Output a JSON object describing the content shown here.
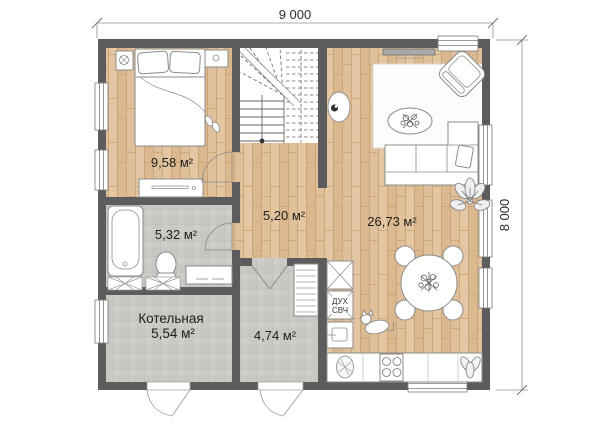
{
  "dimensions": {
    "width": "9 000",
    "height": "8 000"
  },
  "rooms": {
    "bedroom": {
      "area": "9,58 м²"
    },
    "bathroom": {
      "area": "5,32 м²"
    },
    "boiler_room": {
      "name": "Котельная",
      "area": "5,54 м²"
    },
    "hallway": {
      "area": "5,20 м²"
    },
    "entry": {
      "area": "4,74 м²"
    },
    "living_kitchen": {
      "area": "26,73 м²"
    }
  },
  "appliances": {
    "oven": "ДУХ",
    "microwave": "СВЧ"
  },
  "colors": {
    "wall": "#5c5c5c",
    "wood_floor": "#dfbf98",
    "tile_floor": "#cac9c4",
    "furniture_line": "#8b8b8b",
    "dimension_line": "#909090"
  }
}
